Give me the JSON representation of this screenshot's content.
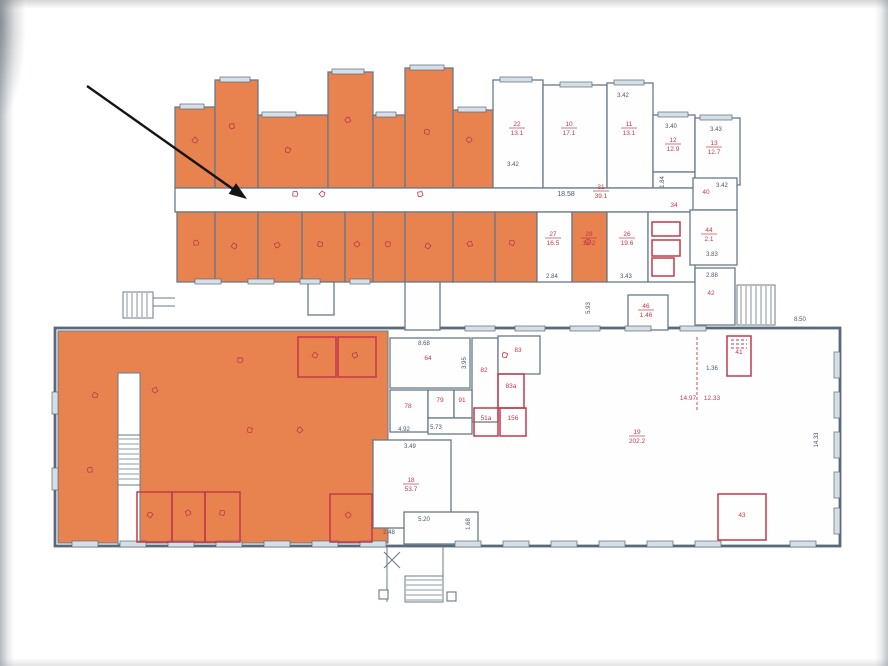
{
  "document": {
    "type": "scanned floor plan with highlighted premises",
    "highlight_color": "#e8824e",
    "wall_color": "#68798a",
    "exterior_wall_color": "#586a7b",
    "annotation_red": "#c23a4a",
    "dim_text_color": "#4a5568",
    "arrow_color": "#141414"
  },
  "arrow": {
    "x1": 87,
    "y1": 86,
    "x2": 247,
    "y2": 199
  },
  "floorplan": {
    "canvas": {
      "w": 888,
      "h": 666
    },
    "rooms": [
      {
        "x": 55,
        "y": 328,
        "w": 785,
        "h": 218,
        "f": "w",
        "s": "ext"
      },
      {
        "x": 58,
        "y": 331,
        "w": 330,
        "h": 212,
        "f": "o",
        "s": "thin"
      },
      {
        "x": 118,
        "y": 373,
        "w": 22,
        "h": 171,
        "f": "w",
        "s": "thin"
      },
      {
        "x": 175,
        "y": 107,
        "w": 40,
        "h": 81,
        "f": "o"
      },
      {
        "x": 215,
        "y": 80,
        "w": 43,
        "h": 108,
        "f": "o"
      },
      {
        "x": 258,
        "y": 115,
        "w": 70,
        "h": 73,
        "f": "o"
      },
      {
        "x": 328,
        "y": 72,
        "w": 45,
        "h": 116,
        "f": "o"
      },
      {
        "x": 373,
        "y": 115,
        "w": 32,
        "h": 73,
        "f": "o"
      },
      {
        "x": 405,
        "y": 68,
        "w": 48,
        "h": 120,
        "f": "o"
      },
      {
        "x": 453,
        "y": 110,
        "w": 40,
        "h": 78,
        "f": "o"
      },
      {
        "x": 493,
        "y": 80,
        "w": 50,
        "h": 108,
        "f": "w"
      },
      {
        "x": 543,
        "y": 85,
        "w": 64,
        "h": 103,
        "f": "w"
      },
      {
        "x": 607,
        "y": 83,
        "w": 46,
        "h": 105,
        "f": "w"
      },
      {
        "x": 653,
        "y": 115,
        "w": 42,
        "h": 57,
        "f": "w"
      },
      {
        "x": 653,
        "y": 172,
        "w": 42,
        "h": 16,
        "f": "w"
      },
      {
        "x": 695,
        "y": 118,
        "w": 45,
        "h": 67,
        "f": "w"
      },
      {
        "x": 175,
        "y": 188,
        "w": 520,
        "h": 24,
        "f": "w"
      },
      {
        "x": 177,
        "y": 212,
        "w": 38,
        "h": 70,
        "f": "o"
      },
      {
        "x": 215,
        "y": 212,
        "w": 43,
        "h": 70,
        "f": "o"
      },
      {
        "x": 258,
        "y": 212,
        "w": 44,
        "h": 70,
        "f": "o"
      },
      {
        "x": 302,
        "y": 212,
        "w": 43,
        "h": 70,
        "f": "o"
      },
      {
        "x": 345,
        "y": 212,
        "w": 28,
        "h": 70,
        "f": "o"
      },
      {
        "x": 373,
        "y": 212,
        "w": 32,
        "h": 70,
        "f": "o"
      },
      {
        "x": 405,
        "y": 212,
        "w": 48,
        "h": 70,
        "f": "o"
      },
      {
        "x": 453,
        "y": 212,
        "w": 42,
        "h": 70,
        "f": "o"
      },
      {
        "x": 495,
        "y": 212,
        "w": 42,
        "h": 70,
        "f": "o"
      },
      {
        "x": 537,
        "y": 212,
        "w": 35,
        "h": 70,
        "f": "w"
      },
      {
        "x": 572,
        "y": 212,
        "w": 35,
        "h": 70,
        "f": "o"
      },
      {
        "x": 607,
        "y": 212,
        "w": 41,
        "h": 70,
        "f": "w"
      },
      {
        "x": 648,
        "y": 212,
        "w": 47,
        "h": 70,
        "f": "w"
      },
      {
        "x": 693,
        "y": 178,
        "w": 44,
        "h": 32,
        "f": "w"
      },
      {
        "x": 690,
        "y": 210,
        "w": 47,
        "h": 55,
        "f": "w"
      },
      {
        "x": 695,
        "y": 268,
        "w": 40,
        "h": 57,
        "f": "w"
      },
      {
        "x": 628,
        "y": 295,
        "w": 40,
        "h": 35,
        "f": "w"
      },
      {
        "x": 308,
        "y": 282,
        "w": 26,
        "h": 33,
        "f": "w"
      },
      {
        "x": 405,
        "y": 282,
        "w": 35,
        "h": 48,
        "f": "w"
      },
      {
        "x": 390,
        "y": 338,
        "w": 80,
        "h": 50,
        "f": "w"
      },
      {
        "x": 472,
        "y": 338,
        "w": 26,
        "h": 84,
        "f": "w"
      },
      {
        "x": 498,
        "y": 336,
        "w": 42,
        "h": 38,
        "f": "w"
      },
      {
        "x": 390,
        "y": 390,
        "w": 38,
        "h": 42,
        "f": "w"
      },
      {
        "x": 428,
        "y": 390,
        "w": 26,
        "h": 28,
        "f": "w"
      },
      {
        "x": 454,
        "y": 390,
        "w": 18,
        "h": 28,
        "f": "w"
      },
      {
        "x": 428,
        "y": 418,
        "w": 44,
        "h": 16,
        "f": "w"
      },
      {
        "x": 373,
        "y": 440,
        "w": 78,
        "h": 88,
        "f": "w"
      },
      {
        "x": 404,
        "y": 512,
        "w": 74,
        "h": 32,
        "f": "w"
      }
    ],
    "redRooms": [
      {
        "x": 498,
        "y": 374,
        "w": 26,
        "h": 34
      },
      {
        "x": 474,
        "y": 408,
        "w": 24,
        "h": 28
      },
      {
        "x": 500,
        "y": 408,
        "w": 26,
        "h": 28
      },
      {
        "x": 727,
        "y": 336,
        "w": 24,
        "h": 40
      },
      {
        "x": 718,
        "y": 494,
        "w": 48,
        "h": 46
      },
      {
        "x": 137,
        "y": 492,
        "w": 35,
        "h": 50
      },
      {
        "x": 172,
        "y": 492,
        "w": 33,
        "h": 50
      },
      {
        "x": 205,
        "y": 492,
        "w": 35,
        "h": 50
      },
      {
        "x": 330,
        "y": 494,
        "w": 42,
        "h": 48
      },
      {
        "x": 298,
        "y": 337,
        "w": 38,
        "h": 40
      },
      {
        "x": 338,
        "y": 337,
        "w": 38,
        "h": 40
      },
      {
        "x": 652,
        "y": 222,
        "w": 28,
        "h": 14
      },
      {
        "x": 652,
        "y": 240,
        "w": 28,
        "h": 16
      },
      {
        "x": 652,
        "y": 258,
        "w": 22,
        "h": 18
      }
    ],
    "stairs": [
      {
        "x": 737,
        "y": 285,
        "w": 38,
        "h": 40,
        "dir": "v"
      },
      {
        "x": 123,
        "y": 292,
        "w": 30,
        "h": 26,
        "dir": "v"
      },
      {
        "x": 118,
        "y": 435,
        "w": 22,
        "h": 50,
        "dir": "h"
      },
      {
        "x": 405,
        "y": 576,
        "w": 38,
        "h": 26,
        "dir": "h"
      }
    ],
    "darkLines": [
      [
        153,
        298,
        175,
        298
      ],
      [
        153,
        306,
        175,
        306
      ],
      [
        387,
        546,
        387,
        602
      ],
      [
        443,
        546,
        443,
        602
      ],
      [
        384,
        552,
        400,
        568
      ],
      [
        400,
        552,
        384,
        568
      ]
    ],
    "redLines": [
      [
        697,
        337,
        697,
        412
      ],
      [
        731,
        340,
        747,
        340
      ],
      [
        731,
        344,
        747,
        344
      ],
      [
        731,
        348,
        747,
        348
      ]
    ],
    "posts": [
      {
        "x": 379,
        "y": 590,
        "w": 9,
        "h": 9
      },
      {
        "x": 447,
        "y": 592,
        "w": 9,
        "h": 9
      }
    ],
    "windows": [
      {
        "x": 180,
        "y": 104,
        "w": 24,
        "h": 5
      },
      {
        "x": 220,
        "y": 77,
        "w": 30,
        "h": 5
      },
      {
        "x": 262,
        "y": 112,
        "w": 34,
        "h": 5
      },
      {
        "x": 332,
        "y": 69,
        "w": 32,
        "h": 5
      },
      {
        "x": 376,
        "y": 112,
        "w": 20,
        "h": 5
      },
      {
        "x": 410,
        "y": 65,
        "w": 34,
        "h": 5
      },
      {
        "x": 458,
        "y": 107,
        "w": 28,
        "h": 5
      },
      {
        "x": 500,
        "y": 77,
        "w": 32,
        "h": 5
      },
      {
        "x": 560,
        "y": 82,
        "w": 32,
        "h": 5
      },
      {
        "x": 614,
        "y": 80,
        "w": 30,
        "h": 5
      },
      {
        "x": 658,
        "y": 112,
        "w": 30,
        "h": 5
      },
      {
        "x": 700,
        "y": 115,
        "w": 32,
        "h": 5
      },
      {
        "x": 195,
        "y": 279,
        "w": 26,
        "h": 5
      },
      {
        "x": 248,
        "y": 279,
        "w": 26,
        "h": 5
      },
      {
        "x": 300,
        "y": 279,
        "w": 20,
        "h": 5
      },
      {
        "x": 350,
        "y": 279,
        "w": 20,
        "h": 5
      },
      {
        "x": 465,
        "y": 326,
        "w": 30,
        "h": 5
      },
      {
        "x": 515,
        "y": 326,
        "w": 30,
        "h": 5
      },
      {
        "x": 570,
        "y": 326,
        "w": 30,
        "h": 5
      },
      {
        "x": 625,
        "y": 326,
        "w": 26,
        "h": 5
      },
      {
        "x": 680,
        "y": 326,
        "w": 26,
        "h": 5
      },
      {
        "x": 72,
        "y": 541,
        "w": 26,
        "h": 6
      },
      {
        "x": 120,
        "y": 541,
        "w": 26,
        "h": 6
      },
      {
        "x": 168,
        "y": 541,
        "w": 26,
        "h": 6
      },
      {
        "x": 216,
        "y": 541,
        "w": 26,
        "h": 6
      },
      {
        "x": 264,
        "y": 541,
        "w": 26,
        "h": 6
      },
      {
        "x": 312,
        "y": 541,
        "w": 26,
        "h": 6
      },
      {
        "x": 360,
        "y": 541,
        "w": 26,
        "h": 6
      },
      {
        "x": 455,
        "y": 541,
        "w": 26,
        "h": 6
      },
      {
        "x": 503,
        "y": 541,
        "w": 26,
        "h": 6
      },
      {
        "x": 551,
        "y": 541,
        "w": 26,
        "h": 6
      },
      {
        "x": 599,
        "y": 541,
        "w": 26,
        "h": 6
      },
      {
        "x": 647,
        "y": 541,
        "w": 26,
        "h": 6
      },
      {
        "x": 695,
        "y": 541,
        "w": 26,
        "h": 6
      },
      {
        "x": 790,
        "y": 541,
        "w": 26,
        "h": 6
      },
      {
        "x": 834,
        "y": 352,
        "w": 6,
        "h": 26
      },
      {
        "x": 834,
        "y": 392,
        "w": 6,
        "h": 26
      },
      {
        "x": 834,
        "y": 432,
        "w": 6,
        "h": 26
      },
      {
        "x": 834,
        "y": 472,
        "w": 6,
        "h": 26
      },
      {
        "x": 834,
        "y": 508,
        "w": 6,
        "h": 26
      },
      {
        "x": 52,
        "y": 392,
        "w": 6,
        "h": 22
      },
      {
        "x": 52,
        "y": 468,
        "w": 6,
        "h": 22
      }
    ],
    "dimLabels": [
      {
        "x": 566,
        "y": 196,
        "t": "18.58",
        "s": 7
      },
      {
        "x": 664,
        "y": 182,
        "t": "1.84",
        "s": 6,
        "r": -90
      },
      {
        "x": 513,
        "y": 166,
        "t": "3.42",
        "s": 6
      },
      {
        "x": 623,
        "y": 97,
        "t": "3.42",
        "s": 6
      },
      {
        "x": 671,
        "y": 128,
        "t": "3.40",
        "s": 6
      },
      {
        "x": 716,
        "y": 131,
        "t": "3.43",
        "s": 6
      },
      {
        "x": 722,
        "y": 187,
        "t": "3.42",
        "s": 6
      },
      {
        "x": 712,
        "y": 256,
        "t": "3.83",
        "s": 6
      },
      {
        "x": 712,
        "y": 277,
        "t": "2.88",
        "s": 6
      },
      {
        "x": 552,
        "y": 278,
        "t": "2.84",
        "s": 6
      },
      {
        "x": 626,
        "y": 278,
        "t": "3.43",
        "s": 6
      },
      {
        "x": 590,
        "y": 308,
        "t": "5.93",
        "s": 6,
        "r": -90
      },
      {
        "x": 800,
        "y": 321,
        "t": "8.50",
        "s": 6
      },
      {
        "x": 424,
        "y": 345,
        "t": "8.68",
        "s": 6
      },
      {
        "x": 466,
        "y": 363,
        "t": "3.95",
        "s": 6,
        "r": -90
      },
      {
        "x": 404,
        "y": 431,
        "t": "4.92",
        "s": 6
      },
      {
        "x": 436,
        "y": 429,
        "t": "5.73",
        "s": 6
      },
      {
        "x": 410,
        "y": 448,
        "t": "3.49",
        "s": 6
      },
      {
        "x": 424,
        "y": 521,
        "t": "5.20",
        "s": 6
      },
      {
        "x": 389,
        "y": 534,
        "t": "2.48",
        "s": 6
      },
      {
        "x": 470,
        "y": 524,
        "t": "1.68",
        "s": 6,
        "r": -90
      },
      {
        "x": 712,
        "y": 370,
        "t": "1.36",
        "s": 6
      },
      {
        "x": 818,
        "y": 440,
        "t": "14.33",
        "s": 6,
        "r": -90
      }
    ],
    "redLabels": [
      {
        "x": 517,
        "y": 126,
        "n": "22",
        "a": "13.1"
      },
      {
        "x": 569,
        "y": 126,
        "n": "10",
        "a": "17.1"
      },
      {
        "x": 629,
        "y": 126,
        "n": "11",
        "a": "13.1"
      },
      {
        "x": 673,
        "y": 142,
        "n": "12",
        "a": "12.9"
      },
      {
        "x": 714,
        "y": 145,
        "n": "13",
        "a": "12.7"
      },
      {
        "x": 601,
        "y": 189,
        "n": "31",
        "a": "39.1"
      },
      {
        "x": 553,
        "y": 236,
        "n": "27",
        "a": "16.5"
      },
      {
        "x": 589,
        "y": 236,
        "n": "28",
        "a": "16.2"
      },
      {
        "x": 627,
        "y": 236,
        "n": "26",
        "a": "19.6"
      },
      {
        "x": 411,
        "y": 482,
        "n": "18",
        "a": "53.7"
      },
      {
        "x": 637,
        "y": 434,
        "n": "19",
        "a": "202.2"
      },
      {
        "x": 709,
        "y": 232,
        "n": "44",
        "a": "2.1"
      },
      {
        "x": 646,
        "y": 308,
        "n": "46",
        "a": "1.46"
      },
      {
        "x": 428,
        "y": 360,
        "n": "64"
      },
      {
        "x": 484,
        "y": 372,
        "n": "82"
      },
      {
        "x": 518,
        "y": 352,
        "n": "83"
      },
      {
        "x": 511,
        "y": 388,
        "n": "83а"
      },
      {
        "x": 408,
        "y": 408,
        "n": "78"
      },
      {
        "x": 440,
        "y": 402,
        "n": "79"
      },
      {
        "x": 462,
        "y": 402,
        "n": "91"
      },
      {
        "x": 486,
        "y": 420,
        "n": "51а"
      },
      {
        "x": 513,
        "y": 420,
        "n": "156"
      },
      {
        "x": 739,
        "y": 354,
        "n": "41"
      },
      {
        "x": 742,
        "y": 517,
        "n": "43"
      },
      {
        "x": 706,
        "y": 194,
        "n": "40"
      },
      {
        "x": 711,
        "y": 295,
        "n": "42"
      },
      {
        "x": 674,
        "y": 207,
        "n": "34"
      },
      {
        "x": 688,
        "y": 400,
        "n": "14.97"
      },
      {
        "x": 712,
        "y": 400,
        "n": "12.33"
      }
    ],
    "marks": [
      [
        195,
        140
      ],
      [
        232,
        126
      ],
      [
        288,
        150
      ],
      [
        348,
        120
      ],
      [
        427,
        132
      ],
      [
        469,
        140
      ],
      [
        196,
        243
      ],
      [
        234,
        246
      ],
      [
        277,
        245
      ],
      [
        320,
        244
      ],
      [
        357,
        244
      ],
      [
        388,
        244
      ],
      [
        428,
        246
      ],
      [
        470,
        244
      ],
      [
        512,
        243
      ],
      [
        588,
        242
      ],
      [
        295,
        194
      ],
      [
        322,
        194
      ],
      [
        420,
        194
      ],
      [
        95,
        395
      ],
      [
        155,
        390
      ],
      [
        250,
        430
      ],
      [
        300,
        430
      ],
      [
        90,
        470
      ],
      [
        150,
        515
      ],
      [
        188,
        513
      ],
      [
        222,
        513
      ],
      [
        348,
        515
      ],
      [
        240,
        360
      ],
      [
        315,
        355
      ],
      [
        355,
        355
      ],
      [
        505,
        355
      ]
    ]
  }
}
